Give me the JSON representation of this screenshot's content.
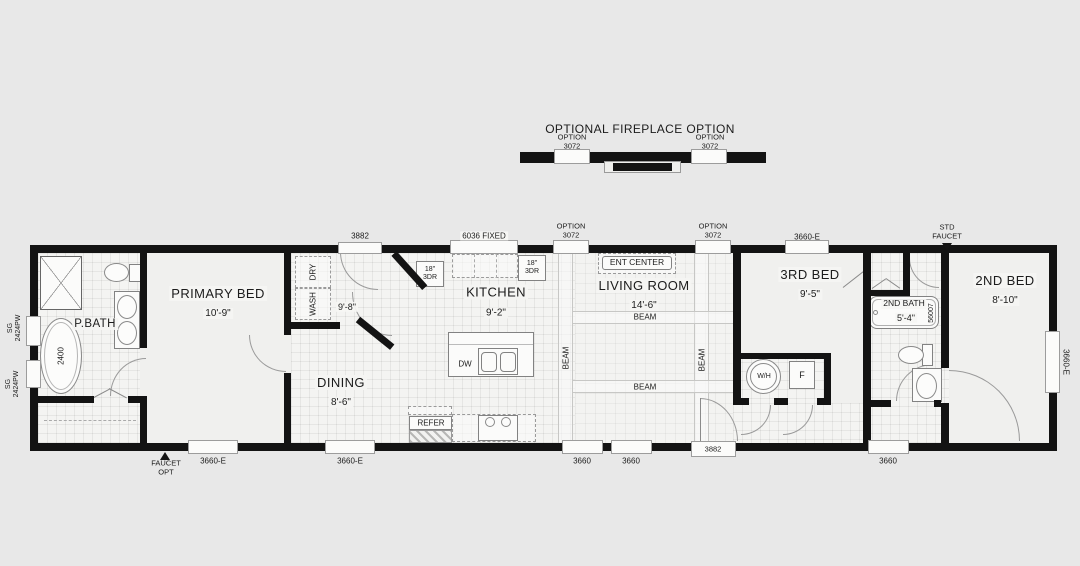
{
  "colors": {
    "background": "#e8e8e8",
    "wall": "#131313",
    "floor": "#f0f0ee",
    "line": "#9a9a9a"
  },
  "fireplace": {
    "title": "OPTIONAL FIREPLACE OPTION",
    "left_option": {
      "line1": "OPTION",
      "line2": "3072"
    },
    "right_option": {
      "line1": "OPTION",
      "line2": "3072"
    }
  },
  "rooms": {
    "p_bath": {
      "name": "P.BATH"
    },
    "primary_bed": {
      "name": "PRIMARY BED",
      "dim": "10'-9\""
    },
    "dining": {
      "name": "DINING",
      "dim": "8'-6\""
    },
    "kitchen": {
      "name": "KITCHEN",
      "dim": "9'-2\""
    },
    "living_room": {
      "name": "LIVING ROOM",
      "dim": "14'-6\""
    },
    "bed3": {
      "name": "3RD BED",
      "dim": "9'-5\""
    },
    "bath2": {
      "name": "2ND BATH",
      "dim": "5'-4\""
    },
    "bed2": {
      "name": "2ND BED",
      "dim": "8'-10\""
    },
    "utility_dim": "9'-8\""
  },
  "windows": {
    "kitchen_fixed": "6036 FIXED",
    "top_option_left": {
      "line1": "OPTION",
      "line2": "3072"
    },
    "top_option_right": {
      "line1": "OPTION",
      "line2": "3072"
    },
    "top_bed3": "3660-E",
    "bottom_primary_1": "3660-E",
    "bottom_primary_2": "3660-E",
    "bottom_living_1": "3660",
    "bottom_living_2": "3660",
    "bottom_bed2": "3660",
    "right_bed2": "3660-E",
    "left_bath_1": {
      "line1": "SG",
      "line2": "2424PW"
    },
    "left_bath_2": {
      "line1": "SG",
      "line2": "2424PW"
    },
    "entry_top": "3882",
    "entry_bottom": "3882"
  },
  "markers": {
    "std_faucet": {
      "line1": "STD",
      "line2": "FAUCET"
    },
    "faucet_opt": {
      "line1": "FAUCET",
      "line2": "OPT"
    }
  },
  "fixtures": {
    "wash": "WASH",
    "dry": "DRY",
    "cabinet_18_3dr": {
      "line1": "18\"",
      "line2": "3DR"
    },
    "ent_center": "ENT CENTER",
    "beam": "BEAM",
    "water_heater": "W/H",
    "furnace": "F",
    "dishwasher": "DW",
    "refrigerator": "REFER",
    "tub_primary_model": "2400",
    "tub_second_model": "56007"
  }
}
